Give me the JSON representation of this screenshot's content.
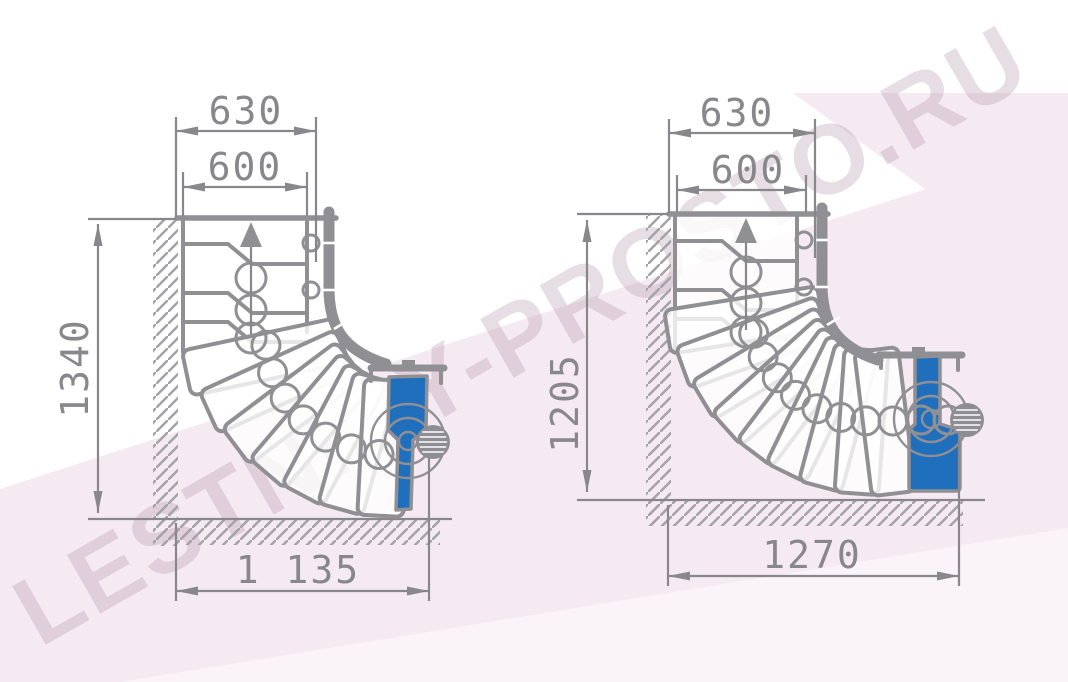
{
  "watermark": "LESTNICY-PROSTO.RU",
  "colors": {
    "line": "#8f8f94",
    "dim": "#87878c",
    "text": "#87878c",
    "blue": "#1f6fbd",
    "hatch": "#a3a3a8",
    "ball": "#8e8e92",
    "background_pink": "#f5eaf2",
    "background_pink_light": "#faf3f8",
    "watermark_tint": "rgba(186,158,178,0.35)"
  },
  "diagrams": [
    {
      "id": "left",
      "dims": {
        "top_outer": "630",
        "top_inner": "600",
        "side": "1340",
        "bottom": "1 135"
      }
    },
    {
      "id": "right",
      "dims": {
        "top_outer": "630",
        "top_inner": "600",
        "side": "1205",
        "bottom": "1270"
      }
    }
  ]
}
